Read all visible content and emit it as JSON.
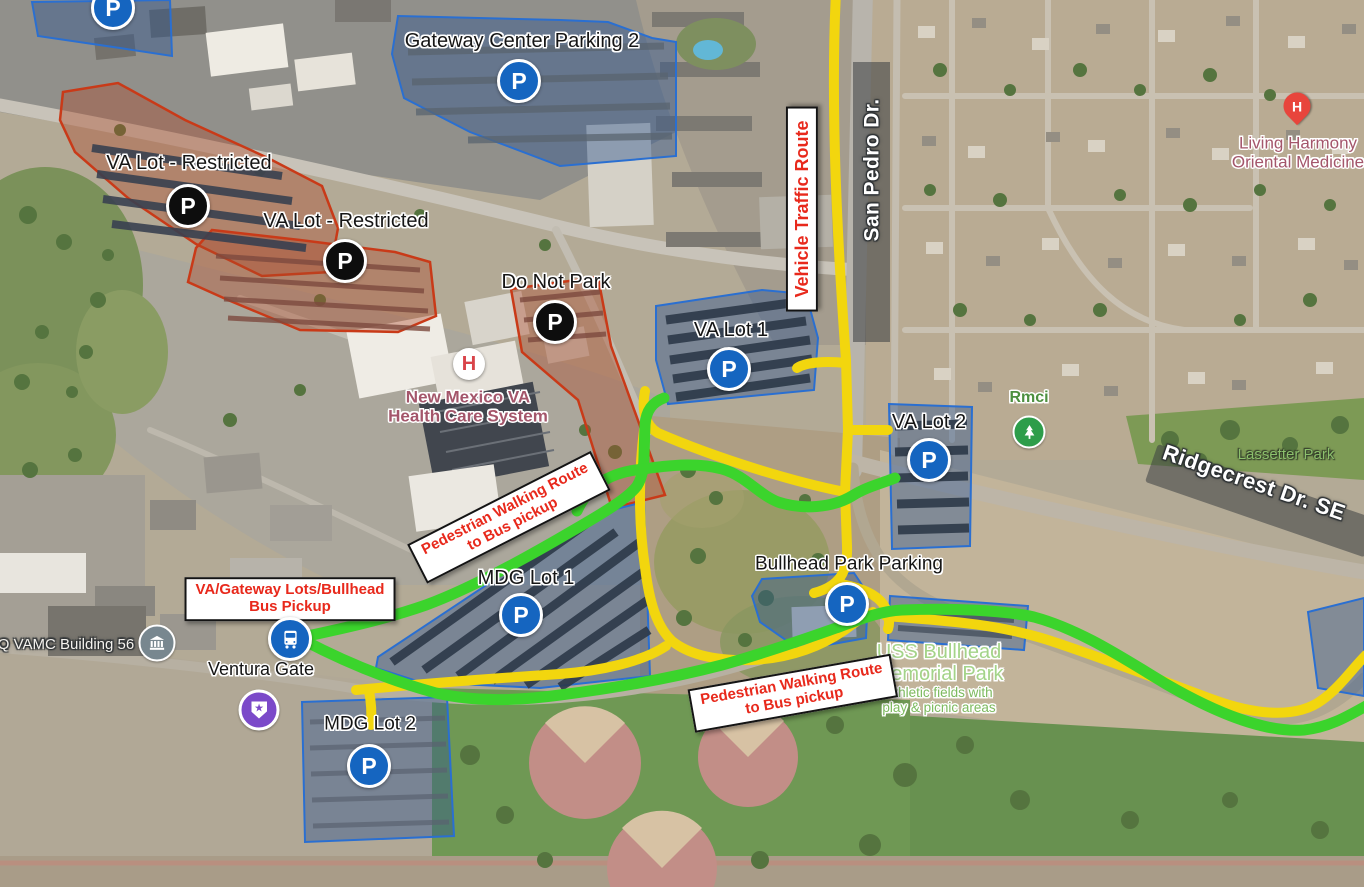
{
  "labels": {
    "gateway_parking2": "Gateway Center Parking 2",
    "va_lot_restricted_1": "VA Lot - Restricted",
    "va_lot_restricted_2": "VA Lot - Restricted",
    "do_not_park": "Do Not Park",
    "va_lot_1": "VA Lot 1",
    "va_lot_2": "VA Lot 2",
    "mdg_lot_1": "MDG Lot 1",
    "mdg_lot_2": "MDG Lot 2",
    "bullhead_park_parking": "Bullhead Park Parking",
    "ventura_gate": "Ventura Gate",
    "vamc_building": "Q VAMC Building 56",
    "san_pedro": "San Pedro Dr.",
    "ridgecrest": "Ridgecrest Dr. SE",
    "lassetter_park": "Lassetter Park",
    "rmci": "Rmci",
    "nm_va_line1": "New Mexico VA",
    "nm_va_line2": "Health Care System",
    "living_harmony_line1": "Living Harmony",
    "living_harmony_line2": "Oriental Medicine",
    "uss_bullhead_line1": "USS Bullhead",
    "uss_bullhead_line2": "Memorial Park",
    "athletic_line1": "Athletic fields with",
    "athletic_line2": "play & picnic areas"
  },
  "callouts": {
    "vehicle_route": "Vehicle Traffic Route",
    "ped_route_line1": "Pedestrian Walking Route",
    "ped_route_line2": "to Bus pickup",
    "bus_pickup_line1": "VA/Gateway Lots/Bullhead",
    "bus_pickup_line2": "Bus Pickup"
  },
  "icons": {
    "parking_glyph": "P",
    "hospital_glyph": "H",
    "star_glyph": "★"
  },
  "colors": {
    "vehicle_route": "#f2d60e",
    "pedestrian_route": "#3bd42c",
    "restricted_outline": "#c93a18",
    "parking_outline": "#2a6fd1",
    "callout_text": "#e8291c",
    "road_label_band": "#3a3e42"
  }
}
